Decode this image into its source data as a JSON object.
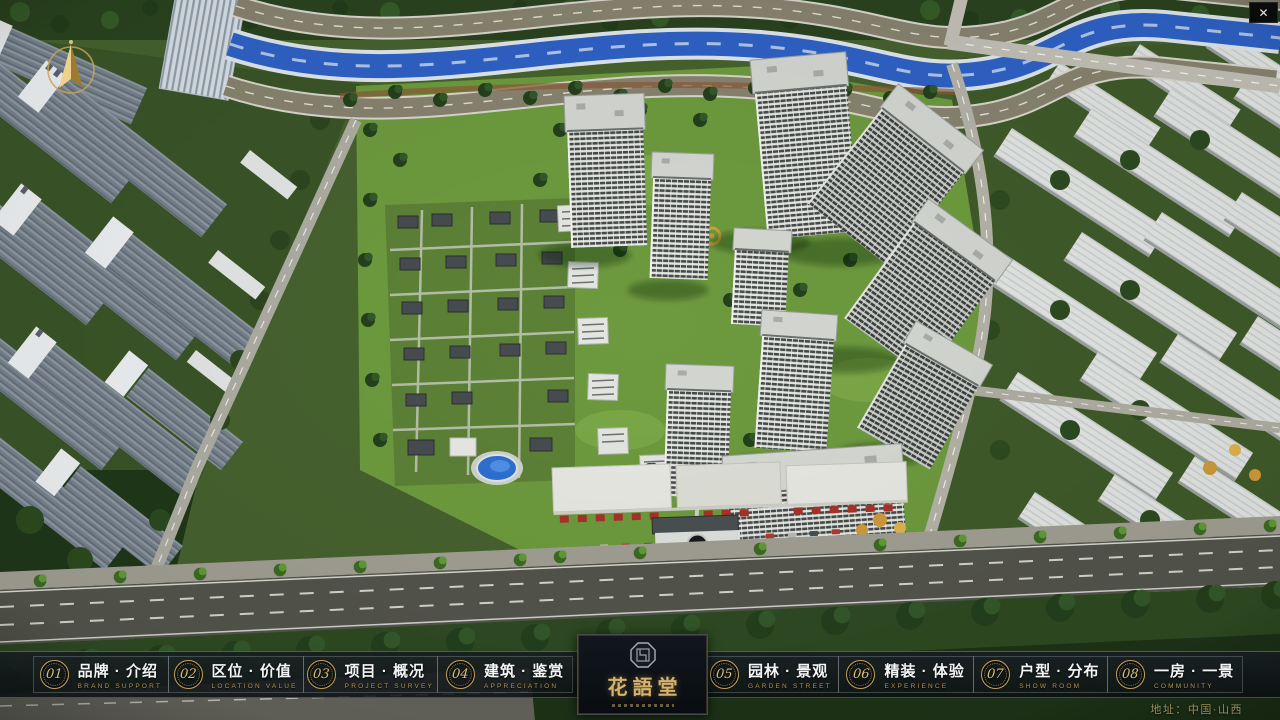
{
  "window": {
    "close_label": "✕"
  },
  "project": {
    "logo_title": "花語堂",
    "address": "地址：中国·山西"
  },
  "nav": {
    "items": [
      {
        "num": "01",
        "zh": "品牌 · 介绍",
        "en": "BRAND SUPPORT"
      },
      {
        "num": "02",
        "zh": "区位 · 价值",
        "en": "LOCATION VALUE"
      },
      {
        "num": "03",
        "zh": "项目 · 概况",
        "en": "PROJECT SURVEY"
      },
      {
        "num": "04",
        "zh": "建筑 · 鉴赏",
        "en": "APPRECIATION"
      },
      {
        "num": "05",
        "zh": "园林 · 景观",
        "en": "GARDEN STREET"
      },
      {
        "num": "06",
        "zh": "精装 · 体验",
        "en": "EXPERIENCE"
      },
      {
        "num": "07",
        "zh": "户型 · 分布",
        "en": "SHOW ROOM"
      },
      {
        "num": "08",
        "zh": "一房 · 一景",
        "en": "COMMUNITY"
      }
    ]
  },
  "colors": {
    "accent_gold": "#c3a258",
    "nav_bg": "rgba(13,18,22,0.85)",
    "nav_text": "#f3f5f7",
    "nav_sub_text": "#b3974f",
    "logo_text": "#d6b26c",
    "address_text": "#97905e",
    "river_blue": "#2f62c6"
  },
  "icons": {
    "compass": "north-arrow",
    "seal": "octagonal-seal"
  }
}
